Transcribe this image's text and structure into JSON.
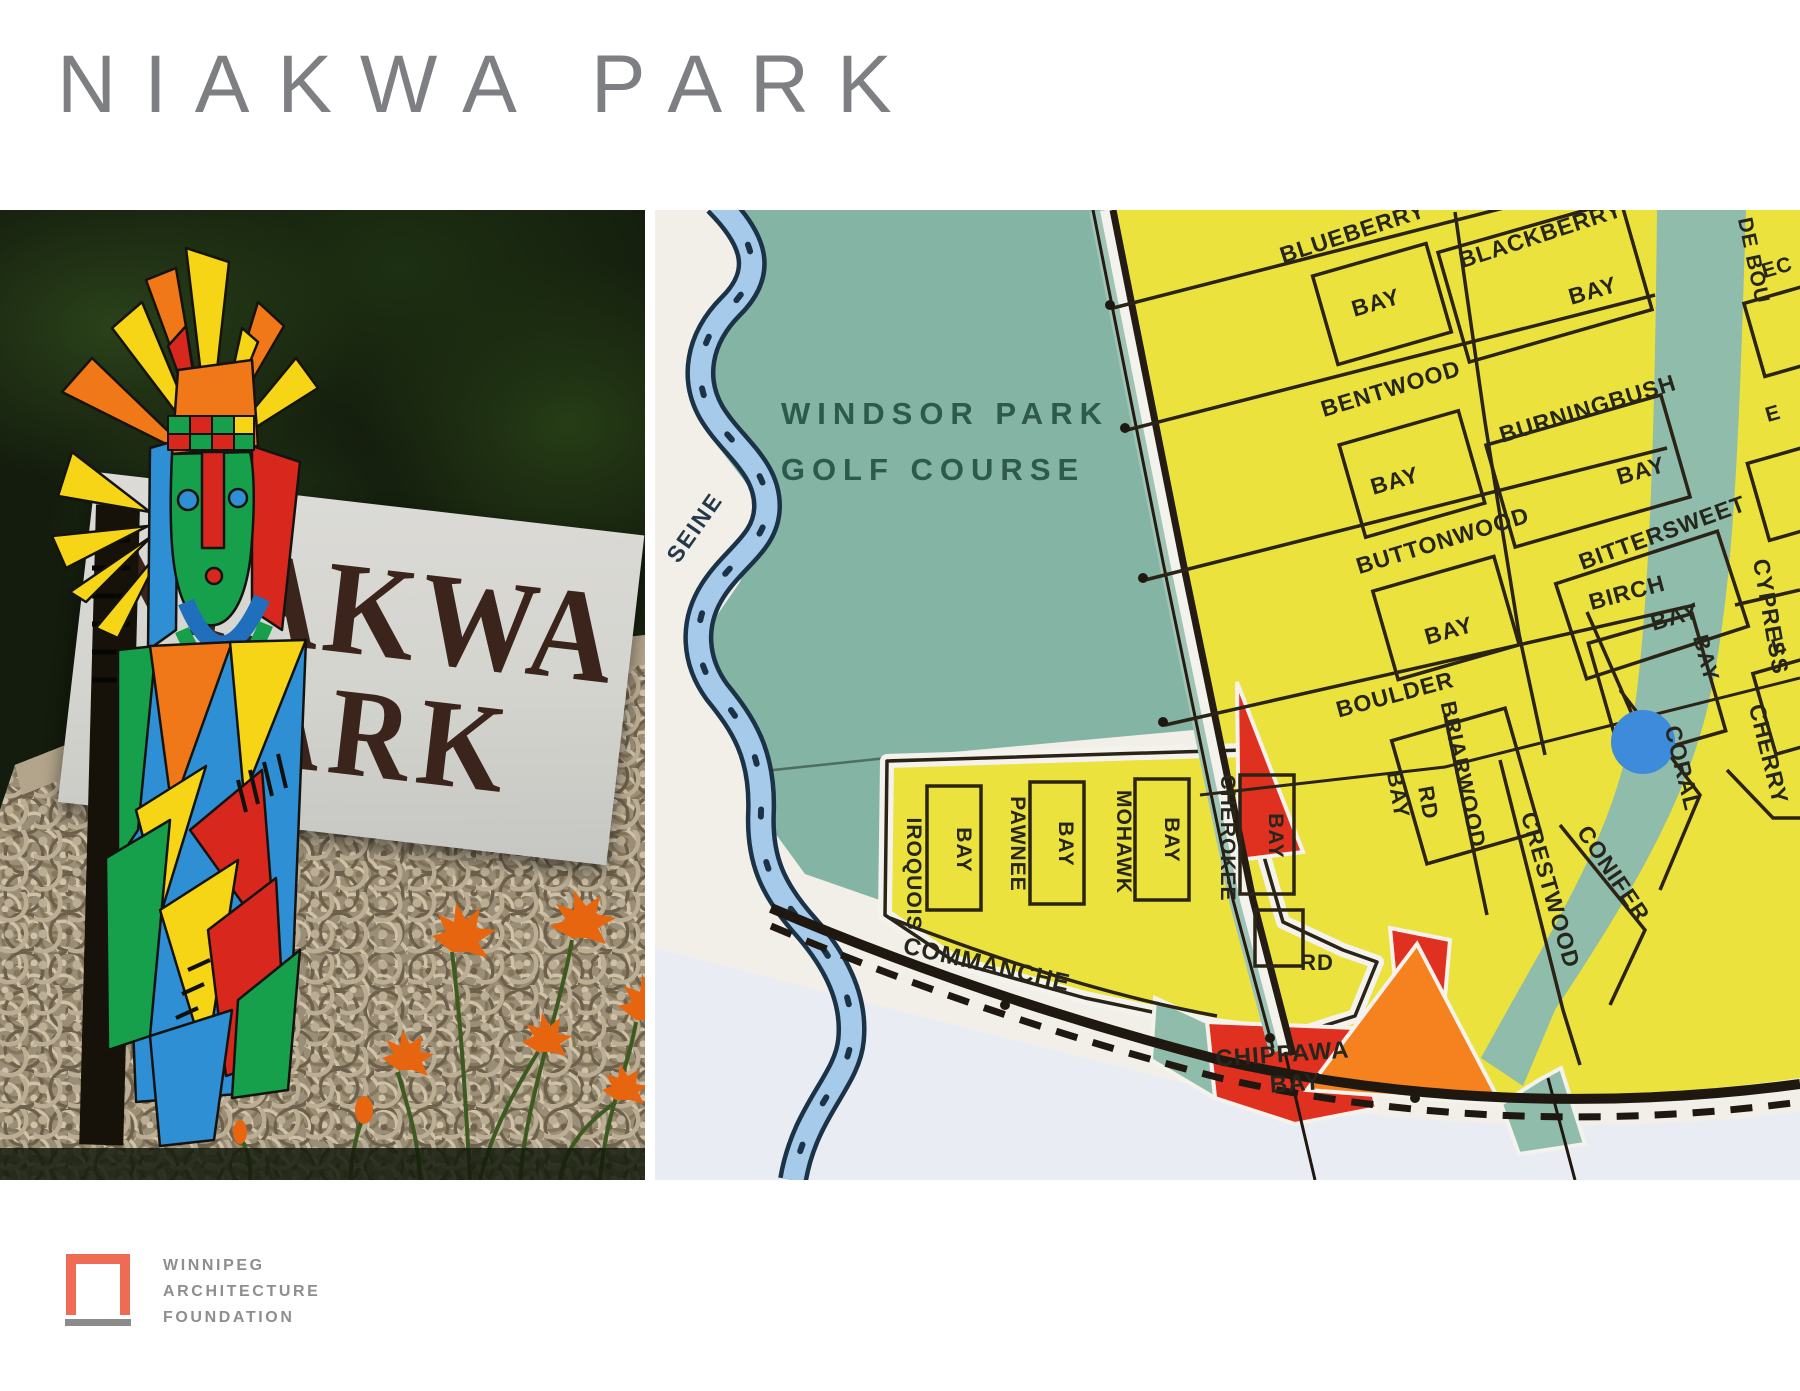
{
  "title": "NIAKWA PARK",
  "photo": {
    "sign_line1": "NIAKWA",
    "sign_line2": "PARK"
  },
  "logo": {
    "line1": "WINNIPEG",
    "line2": "ARCHITECTURE",
    "line3": "FOUNDATION"
  },
  "colors": {
    "title_gray": "#7d7f82",
    "logo_coral": "#ef6b55",
    "logo_gray": "#8e8e90",
    "sign_brown": "#3a241c",
    "map_paper": "#f1efe8",
    "map_paper_low": "#e9edf3",
    "golf_teal": "#83b4a4",
    "residential_yellow": "#ece23e",
    "river_blue": "#a6cbea",
    "river_bank": "#1c3347",
    "pond_blue": "#3e8bdc",
    "accent_red": "#e03020",
    "accent_orange": "#f5821f",
    "street_ink": "#2b2416",
    "golf_text": "#2d5a4c"
  },
  "map": {
    "labels": [
      {
        "t": "WINDSOR PARK",
        "x": 290,
        "y": 214,
        "r": 0,
        "s": 31,
        "c": "#2d5a4c",
        "ls": 7
      },
      {
        "t": "GOLF COURSE",
        "x": 278,
        "y": 270,
        "r": 0,
        "s": 31,
        "c": "#2d5a4c",
        "ls": 7
      },
      {
        "t": "SEINE",
        "x": 46,
        "y": 322,
        "r": -55,
        "s": 23,
        "c": "#24384a",
        "ls": 2
      },
      {
        "t": "BLUEBERRY",
        "x": 700,
        "y": 30,
        "r": -18,
        "s": 23
      },
      {
        "t": "BAY",
        "x": 723,
        "y": 100,
        "r": -16,
        "s": 23
      },
      {
        "t": "BLACKBERRY",
        "x": 888,
        "y": 32,
        "r": -18,
        "s": 23
      },
      {
        "t": "BAY",
        "x": 940,
        "y": 88,
        "r": -16,
        "s": 23
      },
      {
        "t": "BENTWOOD",
        "x": 738,
        "y": 186,
        "r": -17,
        "s": 23
      },
      {
        "t": "BAY",
        "x": 742,
        "y": 278,
        "r": -16,
        "s": 23
      },
      {
        "t": "BURNINGBUSH",
        "x": 935,
        "y": 206,
        "r": -17,
        "s": 23
      },
      {
        "t": "BAY",
        "x": 988,
        "y": 268,
        "r": -16,
        "s": 23
      },
      {
        "t": "BUTTONWOOD",
        "x": 790,
        "y": 338,
        "r": -17,
        "s": 23
      },
      {
        "t": "BAY",
        "x": 796,
        "y": 428,
        "r": -16,
        "s": 23
      },
      {
        "t": "BITTERSWEET",
        "x": 1010,
        "y": 330,
        "r": -20,
        "s": 23
      },
      {
        "t": "BAY",
        "x": 1022,
        "y": 414,
        "r": -16,
        "s": 23
      },
      {
        "t": "BOULDER",
        "x": 742,
        "y": 492,
        "r": -15,
        "s": 23
      },
      {
        "t": "BAY",
        "x": 736,
        "y": 586,
        "r": 80,
        "s": 22
      },
      {
        "t": "RD",
        "x": 766,
        "y": 594,
        "r": 80,
        "s": 22
      },
      {
        "t": "BRIARWOOD",
        "x": 801,
        "y": 566,
        "r": 78,
        "s": 22
      },
      {
        "t": "BIRCH",
        "x": 974,
        "y": 390,
        "r": -15,
        "s": 23
      },
      {
        "t": "BAY",
        "x": 1044,
        "y": 450,
        "r": 75,
        "s": 22
      },
      {
        "t": "CRESTWOOD",
        "x": 888,
        "y": 682,
        "r": 74,
        "s": 23
      },
      {
        "t": "CONIFER",
        "x": 952,
        "y": 668,
        "r": 56,
        "s": 23
      },
      {
        "t": "CORAL",
        "x": 1020,
        "y": 560,
        "r": 76,
        "s": 23
      },
      {
        "t": "CHERRY",
        "x": 1106,
        "y": 546,
        "r": 76,
        "s": 23
      },
      {
        "t": "CYPRESS",
        "x": 1108,
        "y": 408,
        "r": 80,
        "s": 23
      },
      {
        "t": "DE BOU",
        "x": 1092,
        "y": 52,
        "r": 78,
        "s": 21
      },
      {
        "t": "EC",
        "x": 1124,
        "y": 64,
        "r": -16,
        "s": 21
      },
      {
        "t": "E",
        "x": 1120,
        "y": 210,
        "r": -16,
        "s": 21
      },
      {
        "t": "E",
        "x": 1126,
        "y": 442,
        "r": -16,
        "s": 21
      },
      {
        "t": "IROQUOIS",
        "x": 252,
        "y": 664,
        "r": 90,
        "s": 21
      },
      {
        "t": "BAY",
        "x": 302,
        "y": 640,
        "r": 90,
        "s": 21
      },
      {
        "t": "PAWNEE",
        "x": 356,
        "y": 634,
        "r": 90,
        "s": 21
      },
      {
        "t": "BAY",
        "x": 404,
        "y": 634,
        "r": 90,
        "s": 21
      },
      {
        "t": "MOHAWK",
        "x": 462,
        "y": 632,
        "r": 90,
        "s": 21
      },
      {
        "t": "BAY",
        "x": 510,
        "y": 630,
        "r": 90,
        "s": 21
      },
      {
        "t": "CHEROKEE",
        "x": 566,
        "y": 628,
        "r": 90,
        "s": 21
      },
      {
        "t": "BAY",
        "x": 614,
        "y": 626,
        "r": 90,
        "s": 21
      },
      {
        "t": "COMMANCHE",
        "x": 330,
        "y": 762,
        "r": 13,
        "s": 24
      },
      {
        "t": "RD",
        "x": 662,
        "y": 760,
        "r": 0,
        "s": 22
      },
      {
        "t": "CHIPPAWA",
        "x": 628,
        "y": 852,
        "r": -4,
        "s": 24
      },
      {
        "t": "BAY",
        "x": 641,
        "y": 881,
        "r": -4,
        "s": 24
      }
    ]
  }
}
